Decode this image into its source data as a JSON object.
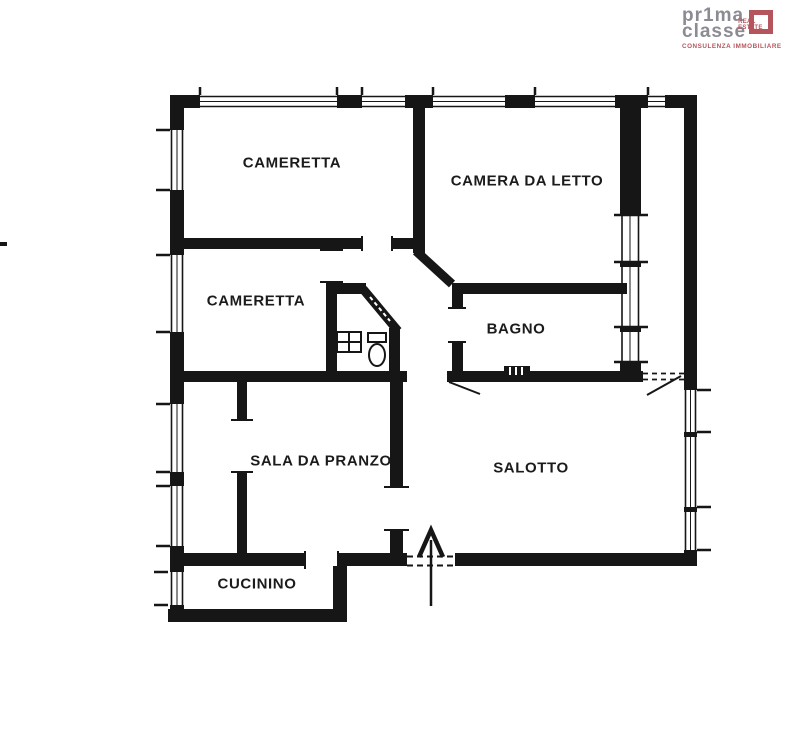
{
  "logo": {
    "brand_top": "pr1ma",
    "brand_bottom": "classe",
    "mark_line1": "REAL",
    "mark_line2": "ESTATE",
    "tagline": "CONSULENZA IMMOBILIARE",
    "accent_color": "#b5545c",
    "brand_color": "#8b8b94"
  },
  "floorplan": {
    "ink_color": "#161616",
    "rooms": [
      {
        "name": "CAMERETTA"
      },
      {
        "name": "CAMERA DA LETTO"
      },
      {
        "name": "CAMERETTA"
      },
      {
        "name": "BAGNO"
      },
      {
        "name": "SALA DA PRANZO"
      },
      {
        "name": "SALOTTO"
      },
      {
        "name": "CUCININO"
      }
    ],
    "features": {
      "entrance_arrow": "main-entrance",
      "wc_fixtures": [
        "sink",
        "toilet"
      ]
    }
  }
}
